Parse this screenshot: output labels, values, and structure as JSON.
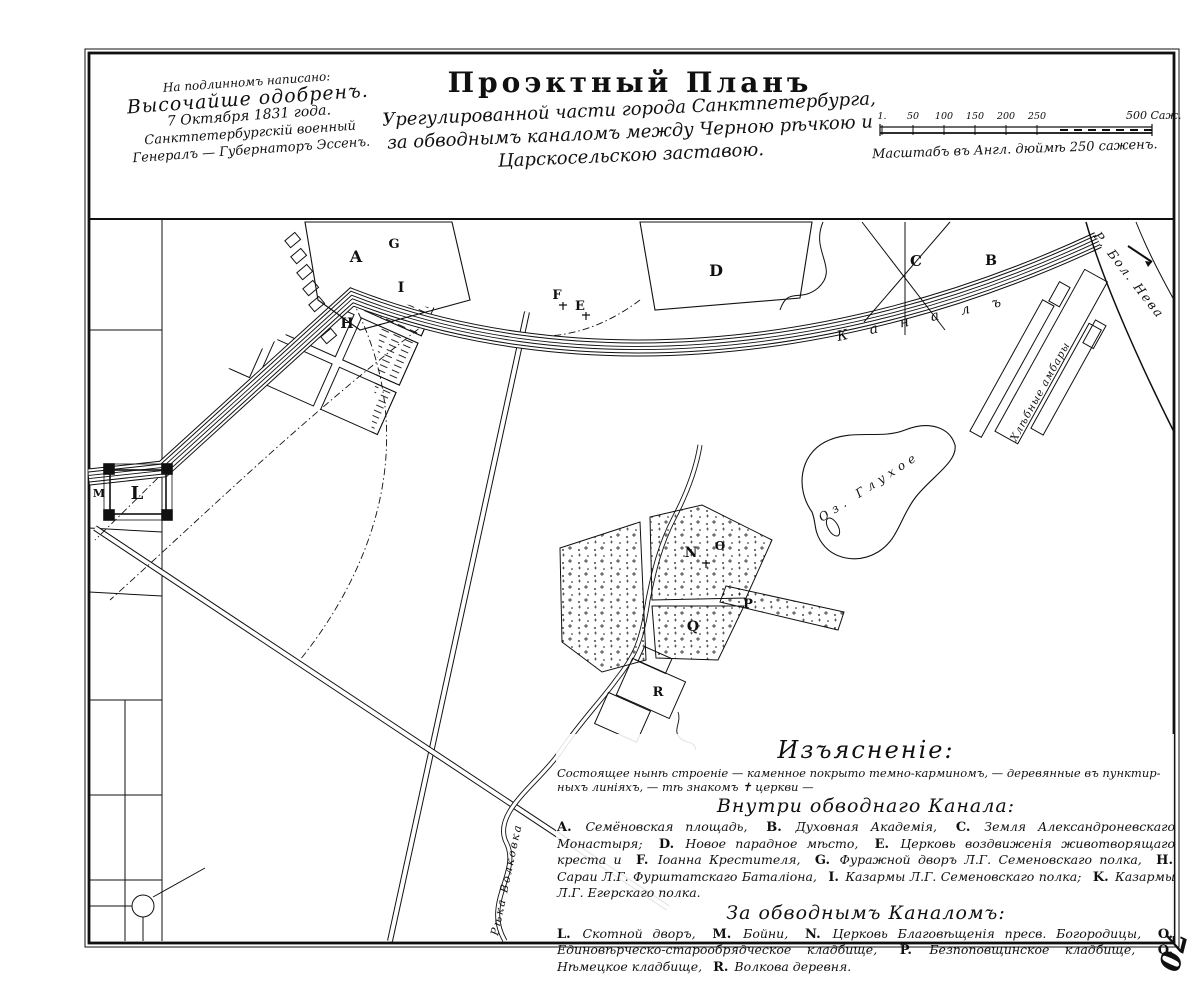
{
  "document": {
    "approval_note": {
      "lines": [
        "На подлинномъ написано:",
        "Высочайше одобренъ.",
        "7 Октября 1831 года.",
        "Санктпетербургскій военный",
        "Генералъ — Губернаторъ Эссенъ."
      ]
    },
    "title": "Проэктный Планъ",
    "subtitle_lines": [
      "Урегулированной части города Санктпетербурга,",
      "за обводнымъ каналомъ между Черною рѣчкою и",
      "Царскосельскою заставою."
    ],
    "sheet_mark": "70"
  },
  "scale": {
    "tick_labels": [
      "1.",
      "50",
      "100",
      "150",
      "200",
      "250"
    ],
    "end_label": "500 Саж.",
    "caption": "Масштабъ въ Англ. дюймѣ 250 саженъ."
  },
  "map": {
    "labels": [
      {
        "text": "К а н а л ъ",
        "x": 838,
        "y": 341,
        "rot": -12,
        "size": 14,
        "ls": 9
      },
      {
        "text": "Р. Бол. Нева",
        "x": 1093,
        "y": 236,
        "rot": 52,
        "size": 12.5,
        "ls": 2
      },
      {
        "text": "Оз. Глухое",
        "x": 822,
        "y": 522,
        "rot": -33,
        "size": 12,
        "ls": 5
      },
      {
        "text": "Рѣка Волковка",
        "x": 498,
        "y": 936,
        "rot": -78,
        "size": 11,
        "ls": 2
      },
      {
        "text": "Хлѣбные амбары",
        "x": 1016,
        "y": 442,
        "rot": -61,
        "size": 10.5,
        "ls": 1
      }
    ],
    "markers": [
      {
        "label": "A",
        "x": 356,
        "y": 262,
        "size": 16
      },
      {
        "label": "G",
        "x": 394,
        "y": 248,
        "size": 13
      },
      {
        "label": "I",
        "x": 401,
        "y": 292,
        "size": 14
      },
      {
        "label": "H",
        "x": 347,
        "y": 328,
        "size": 14
      },
      {
        "label": "F",
        "x": 557,
        "y": 299,
        "size": 13
      },
      {
        "label": "E",
        "x": 580,
        "y": 310,
        "size": 13
      },
      {
        "label": "D",
        "x": 716,
        "y": 276,
        "size": 16
      },
      {
        "label": "C",
        "x": 916,
        "y": 266,
        "size": 15
      },
      {
        "label": "B",
        "x": 991,
        "y": 265,
        "size": 14
      },
      {
        "label": "M",
        "x": 99,
        "y": 497,
        "size": 11
      },
      {
        "label": "L",
        "x": 137,
        "y": 499,
        "size": 18
      },
      {
        "label": "N",
        "x": 691,
        "y": 557,
        "size": 14
      },
      {
        "label": "Ѳ",
        "x": 720,
        "y": 550,
        "size": 12
      },
      {
        "label": "P",
        "x": 748,
        "y": 608,
        "size": 13
      },
      {
        "label": "Q",
        "x": 693,
        "y": 631,
        "size": 14
      },
      {
        "label": "R",
        "x": 658,
        "y": 696,
        "size": 13
      }
    ]
  },
  "legend": {
    "title": "Изъясненіе:",
    "note_lines": [
      "Состоящее нынѣ строеніе — каменное покрыто темно-карминомъ, — деревянные въ пунктир-",
      "ныхъ линіяхъ, — тѣ знакомъ ✝ церкви —"
    ],
    "inside": {
      "header": "Внутри обводнаго Канала:",
      "items": [
        {
          "k": "A.",
          "t": "Семёновская площадь,"
        },
        {
          "k": "B.",
          "t": "Духовная Академія,"
        },
        {
          "k": "C.",
          "t": "Земля Александроневскаго Монастыря;"
        },
        {
          "k": "D.",
          "t": "Новое парадное мѣсто,"
        },
        {
          "k": "E.",
          "t": "Церковь воздвиженія животворящаго креста и"
        },
        {
          "k": "F.",
          "t": "Іоанна Крестителя,"
        },
        {
          "k": "G.",
          "t": "Фуражной дворъ Л.Г. Семеновскаго полка,"
        },
        {
          "k": "H.",
          "t": "Сараи Л.Г. Фурштатскаго Баталіона,"
        },
        {
          "k": "I.",
          "t": "Казармы Л.Г. Семеновскаго полка;"
        },
        {
          "k": "K.",
          "t": "Казармы Л.Г. Егерскаго полка."
        }
      ]
    },
    "beyond": {
      "header": "За обводнымъ Каналомъ:",
      "items": [
        {
          "k": "L.",
          "t": "Скотной дворъ,"
        },
        {
          "k": "M.",
          "t": "Бойни,"
        },
        {
          "k": "N.",
          "t": "Церковь Благовѣщенія пресв. Богородицы,"
        },
        {
          "k": "O.",
          "t": "Единовѣрческо-старообрядческое кладбище,"
        },
        {
          "k": "P.",
          "t": "Безпоповщинское кладбище,"
        },
        {
          "k": "Q.",
          "t": "Нѣмецкое кладбище,"
        },
        {
          "k": "R.",
          "t": "Волкова деревня."
        }
      ]
    }
  }
}
